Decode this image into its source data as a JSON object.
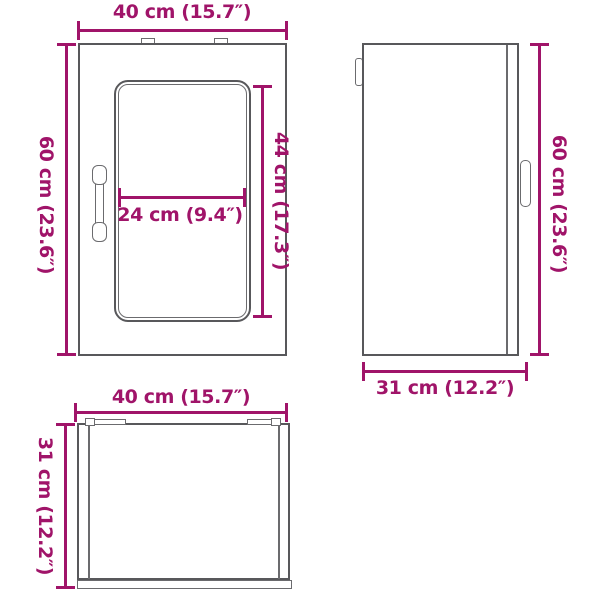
{
  "colors": {
    "accent": "#A01469",
    "outline": "#58585B"
  },
  "views": {
    "front": {
      "width_label": "40 cm (15.7″)",
      "height_label": "60 cm (23.6″)",
      "glass_width_label": "24 cm (9.4″)",
      "glass_height_label": "44 cm (17.3″)"
    },
    "side": {
      "height_label": "60 cm (23.6″)",
      "depth_label": "31 cm (12.2″)"
    },
    "top": {
      "width_label": "40 cm (15.7″)",
      "depth_label": "31 cm (12.2″)"
    }
  }
}
